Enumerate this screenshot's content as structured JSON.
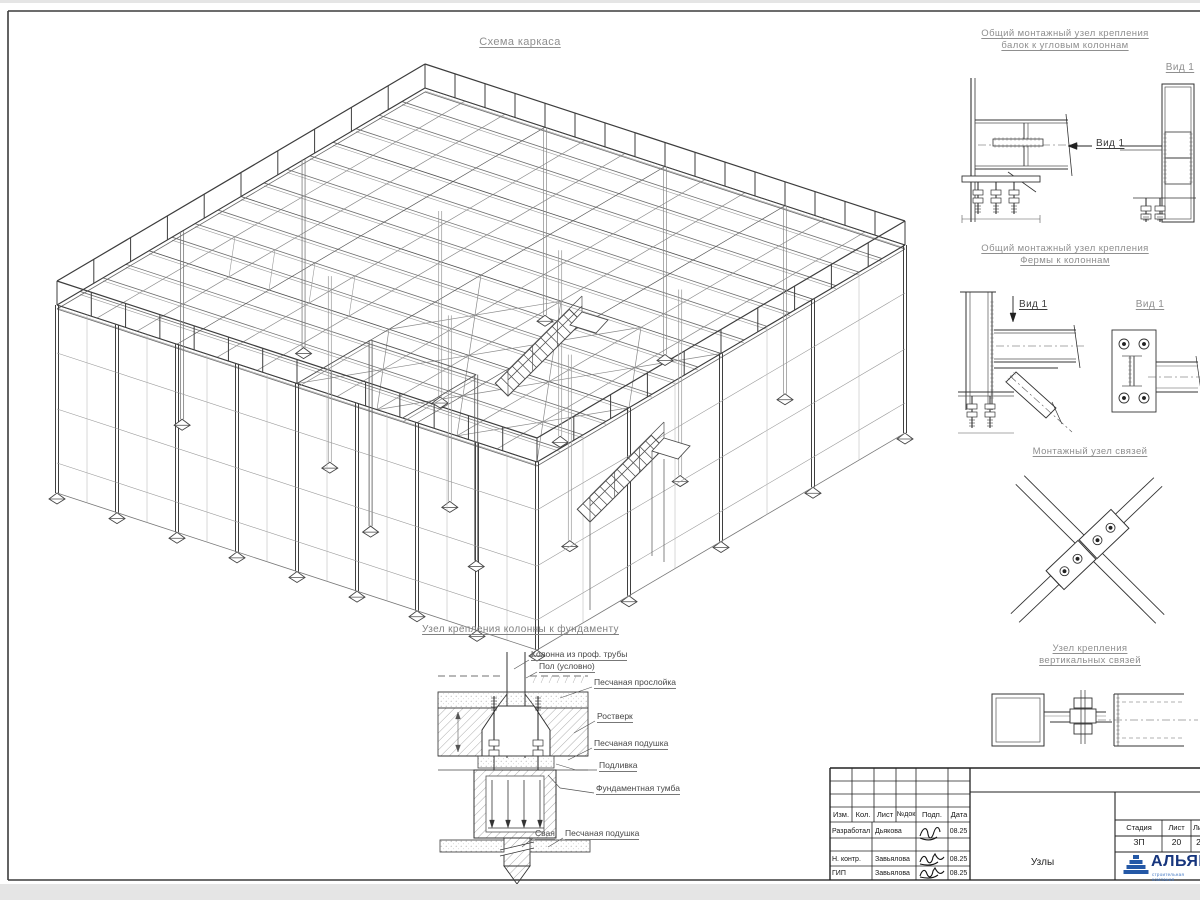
{
  "sheet": {
    "background": "#ffffff",
    "margin_color": "#e5e5e5",
    "line_color": "#4a4a4a",
    "accent_blue": "#2458a6"
  },
  "drawing": {
    "title": "Схема каркаса"
  },
  "details": {
    "beam_corner": {
      "title1": "Общий монтажный узел крепления",
      "title2": "балок к угловым колоннам",
      "view_label": "Вид 1",
      "arrow_label": "Вид 1"
    },
    "truss_column": {
      "title1": "Общий монтажный узел крепления",
      "title2": "Фермы к колоннам",
      "view_label": "Вид 1",
      "arrow_label": "Вид 1"
    },
    "braces": {
      "title": "Монтажный узел связей"
    },
    "vertical_braces": {
      "title1": "Узел крепления",
      "title2": "вертикальных связей"
    }
  },
  "foundation": {
    "title": "Узел крепления колонны к фундаменту",
    "labels": [
      "Колонна из проф. трубы",
      "Пол (условно)",
      "Песчаная прослойка",
      "Ростверк",
      "Песчаная подушка",
      "Подливка",
      "Фундаментная тумба",
      "Свая",
      "Песчаная подушка"
    ]
  },
  "title_block": {
    "header_cols": [
      "Изм.",
      "Кол.",
      "Лист",
      "№док",
      "Подп.",
      "Дата"
    ],
    "sign_rows": [
      {
        "role": "Разработал",
        "name": "Дьякова",
        "date": "08.25"
      },
      {
        "role": "Н. контр.",
        "name": "Завьялова",
        "date": "08.25"
      },
      {
        "role": "ГИП",
        "name": "Завьялова",
        "date": "08.25"
      }
    ],
    "doc_title": "Узлы",
    "stage": {
      "headers": [
        "Стадия",
        "Лист",
        "Лист"
      ],
      "values": [
        "ЗП",
        "20",
        "2"
      ]
    },
    "logo": {
      "name": "АЛЬЯНС",
      "tagline": "строительная компания"
    }
  }
}
